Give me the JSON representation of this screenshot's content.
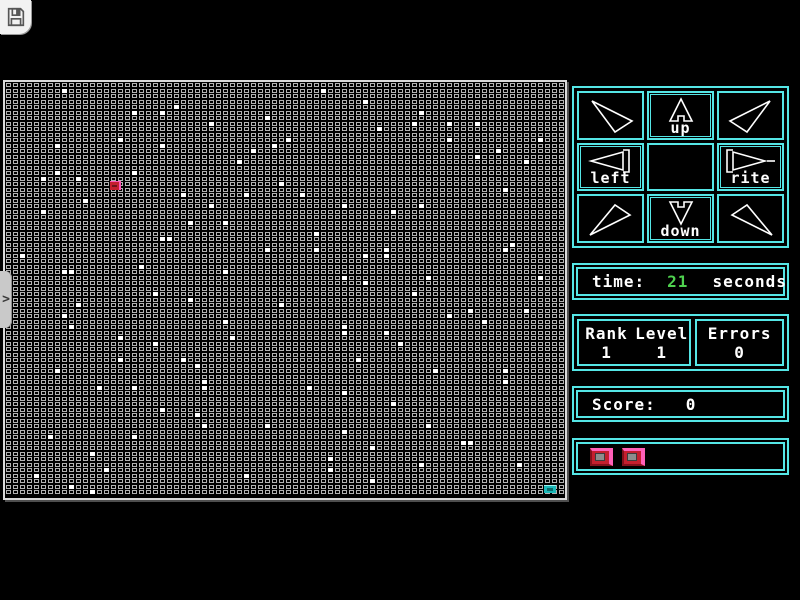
{
  "toolbar": {
    "save_button": "save-game"
  },
  "dpad": {
    "up_label": "up",
    "down_label": "down",
    "left_label": "left",
    "rite_label": "rite"
  },
  "time_panel": {
    "label": "time:",
    "value": "21",
    "unit": "seconds"
  },
  "rank_panel": {
    "rank_label": "Rank",
    "level_label": "Level",
    "rank_value": "1",
    "level_value": "1"
  },
  "errors_panel": {
    "label": "Errors",
    "value": "0"
  },
  "score_panel": {
    "label": "Score:",
    "value": "0"
  },
  "lives_panel": {
    "count": 2
  },
  "side_tab": {
    "chevron": ">"
  },
  "colors": {
    "accent_cyan": "#55e6e6",
    "time_green": "#4fd14f",
    "cell_grey": "#b2b2b2",
    "dot_white": "#ffffff",
    "player_red": "#c41f2e",
    "player_pink": "#ff55b5",
    "player_dark": "#70121c",
    "goal_teal": "#1ab8b8",
    "goal_dark": "#0c6c6c",
    "goal_light": "#9ff0f0"
  },
  "grid": {
    "cols": 80,
    "rows": 75,
    "player": {
      "col": 15,
      "row": 18
    },
    "goal": {
      "col": 77,
      "row": 73
    },
    "dots": [
      [
        8,
        1
      ],
      [
        24,
        4
      ],
      [
        18,
        5
      ],
      [
        22,
        5
      ],
      [
        37,
        6
      ],
      [
        29,
        7
      ],
      [
        16,
        10
      ],
      [
        7,
        11
      ],
      [
        22,
        11
      ],
      [
        38,
        11
      ],
      [
        35,
        12
      ],
      [
        33,
        14
      ],
      [
        18,
        16
      ],
      [
        7,
        16
      ],
      [
        5,
        17
      ],
      [
        10,
        17
      ],
      [
        39,
        18
      ],
      [
        25,
        20
      ],
      [
        34,
        20
      ],
      [
        11,
        21
      ],
      [
        29,
        22
      ],
      [
        5,
        23
      ],
      [
        26,
        25
      ],
      [
        31,
        25
      ],
      [
        22,
        28
      ],
      [
        23,
        28
      ],
      [
        37,
        30
      ],
      [
        2,
        31
      ],
      [
        19,
        33
      ],
      [
        8,
        34
      ],
      [
        9,
        34
      ],
      [
        31,
        34
      ],
      [
        45,
        1
      ],
      [
        51,
        3
      ],
      [
        59,
        5
      ],
      [
        58,
        7
      ],
      [
        63,
        7
      ],
      [
        67,
        7
      ],
      [
        53,
        8
      ],
      [
        40,
        10
      ],
      [
        63,
        10
      ],
      [
        76,
        10
      ],
      [
        70,
        12
      ],
      [
        67,
        13
      ],
      [
        74,
        14
      ],
      [
        71,
        19
      ],
      [
        42,
        20
      ],
      [
        48,
        22
      ],
      [
        59,
        22
      ],
      [
        55,
        23
      ],
      [
        44,
        27
      ],
      [
        72,
        29
      ],
      [
        44,
        30
      ],
      [
        54,
        30
      ],
      [
        71,
        30
      ],
      [
        51,
        31
      ],
      [
        54,
        31
      ],
      [
        48,
        35
      ],
      [
        60,
        35
      ],
      [
        76,
        35
      ],
      [
        51,
        36
      ],
      [
        21,
        38
      ],
      [
        26,
        39
      ],
      [
        10,
        40
      ],
      [
        39,
        40
      ],
      [
        8,
        42
      ],
      [
        31,
        43
      ],
      [
        9,
        44
      ],
      [
        16,
        46
      ],
      [
        32,
        46
      ],
      [
        21,
        47
      ],
      [
        16,
        50
      ],
      [
        25,
        50
      ],
      [
        27,
        51
      ],
      [
        7,
        52
      ],
      [
        28,
        54
      ],
      [
        13,
        55
      ],
      [
        18,
        55
      ],
      [
        28,
        55
      ],
      [
        22,
        59
      ],
      [
        27,
        60
      ],
      [
        28,
        62
      ],
      [
        37,
        62
      ],
      [
        6,
        64
      ],
      [
        18,
        64
      ],
      [
        12,
        67
      ],
      [
        14,
        70
      ],
      [
        4,
        71
      ],
      [
        34,
        71
      ],
      [
        9,
        73
      ],
      [
        12,
        74
      ],
      [
        58,
        38
      ],
      [
        66,
        41
      ],
      [
        74,
        41
      ],
      [
        63,
        42
      ],
      [
        68,
        43
      ],
      [
        48,
        44
      ],
      [
        48,
        45
      ],
      [
        54,
        45
      ],
      [
        56,
        47
      ],
      [
        50,
        50
      ],
      [
        61,
        52
      ],
      [
        71,
        52
      ],
      [
        71,
        54
      ],
      [
        43,
        55
      ],
      [
        48,
        56
      ],
      [
        55,
        58
      ],
      [
        60,
        62
      ],
      [
        48,
        63
      ],
      [
        65,
        65
      ],
      [
        66,
        65
      ],
      [
        52,
        66
      ],
      [
        46,
        68
      ],
      [
        59,
        69
      ],
      [
        73,
        69
      ],
      [
        46,
        70
      ],
      [
        52,
        72
      ]
    ]
  }
}
